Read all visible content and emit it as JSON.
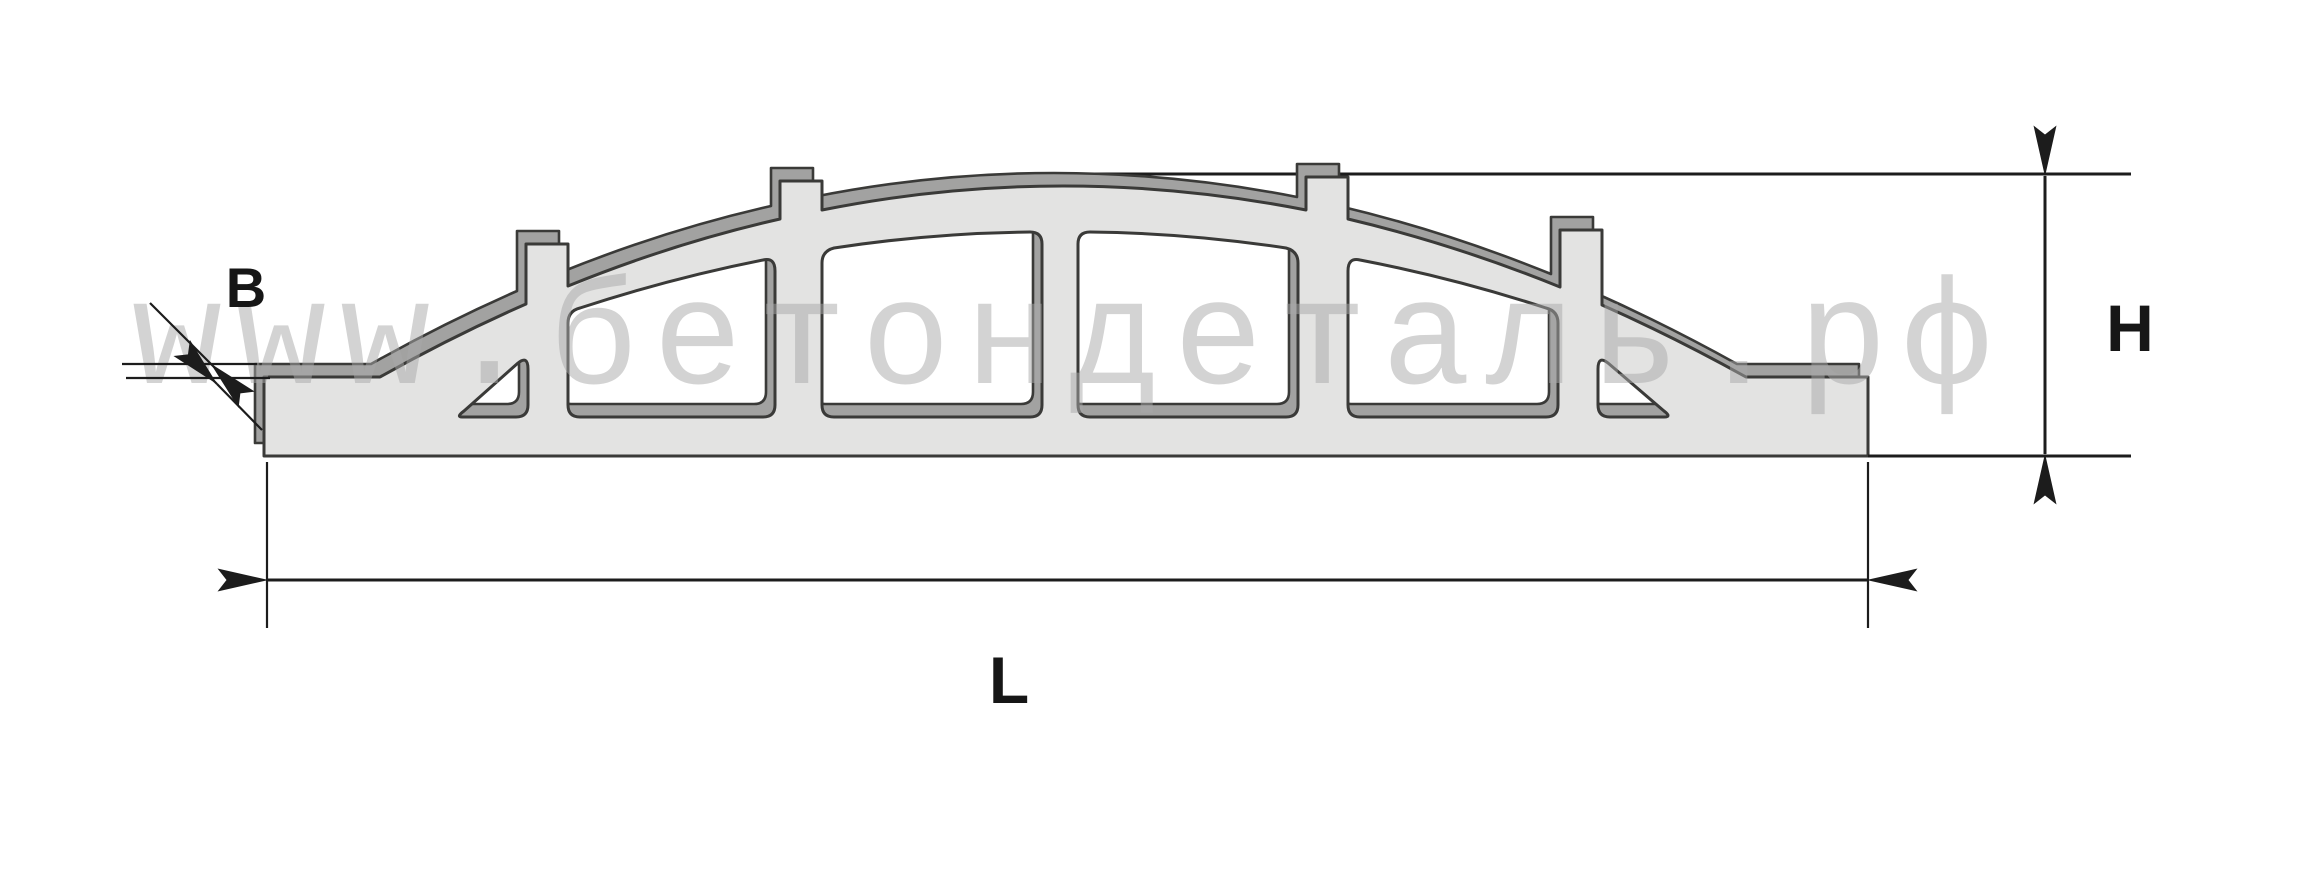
{
  "diagram": {
    "type": "technical-dimension-drawing",
    "subject": "arched openwork concrete fence panel, elevation view with depth",
    "labels": {
      "thickness": "B",
      "height": "H",
      "length": "L"
    },
    "watermark": "www.бетондеталь.рф",
    "counts": {
      "window_openings": "6",
      "top_tabs": "4"
    },
    "colors": {
      "background": "#ffffff",
      "panel_face": "#e3e3e2",
      "panel_depth": "#a2a2a1",
      "outline": "#3a3a38",
      "dimension": "#1c1c1c",
      "label_text": "#161616",
      "watermark": "#a9a9a9"
    }
  }
}
